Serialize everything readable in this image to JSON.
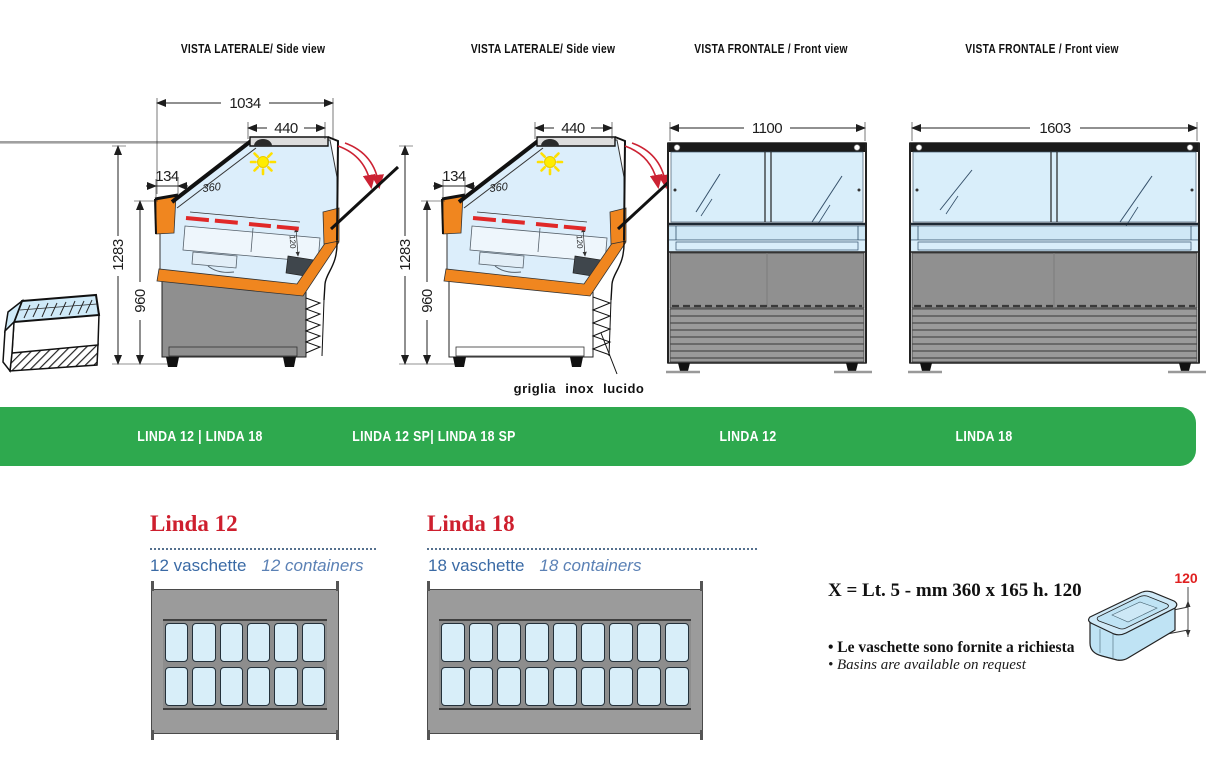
{
  "banner": {
    "color": "#2EA94E",
    "labels": [
      "LINDA 12 | LINDA 18",
      "LINDA 12 SP| LINDA 18 SP",
      "LINDA 12",
      "LINDA 18"
    ]
  },
  "views": [
    {
      "title": "VISTA LATERALE/ Side view",
      "dims": {
        "depth": "1034",
        "lid_width": "440",
        "front_ledge": "134",
        "total_height": "1283",
        "counter_height": "960",
        "display_depth": "360",
        "inner_h": "120"
      }
    },
    {
      "title": "VISTA LATERALE/ Side view",
      "note": "griglia inox lucido",
      "dims": {
        "lid_width": "440",
        "front_ledge": "134",
        "total_height": "1283",
        "counter_height": "960",
        "display_depth": "360",
        "inner_h": "120"
      }
    },
    {
      "title": "VISTA FRONTALE / Front view",
      "dims": {
        "width": "1100"
      }
    },
    {
      "title": "VISTA FRONTALE / Front view",
      "dims": {
        "width": "1603"
      }
    }
  ],
  "products": [
    {
      "name": "Linda 12",
      "subtitle_it": "12 vaschette",
      "subtitle_en": "12 containers",
      "container_rows": 2,
      "container_cols": 6
    },
    {
      "name": "Linda 18",
      "subtitle_it": "18 vaschette",
      "subtitle_en": "18 containers",
      "container_rows": 2,
      "container_cols": 9
    }
  ],
  "info": {
    "spec": "X = Lt. 5 - mm 360 x 165 h. 120",
    "bullet_it": "• Le vaschette sono fornite a richiesta",
    "bullet_en": "• Basins are available on request",
    "basin_height": "120"
  },
  "colors": {
    "accent_green": "#2EA94E",
    "heading_red": "#CE1F2E",
    "subtitle_blue": "#3A6AA5",
    "insulation_orange": "#F0861F",
    "glass_blue": "#D9EEFA",
    "body_gray": "#8F8F8F",
    "heater_red": "#E02828"
  }
}
